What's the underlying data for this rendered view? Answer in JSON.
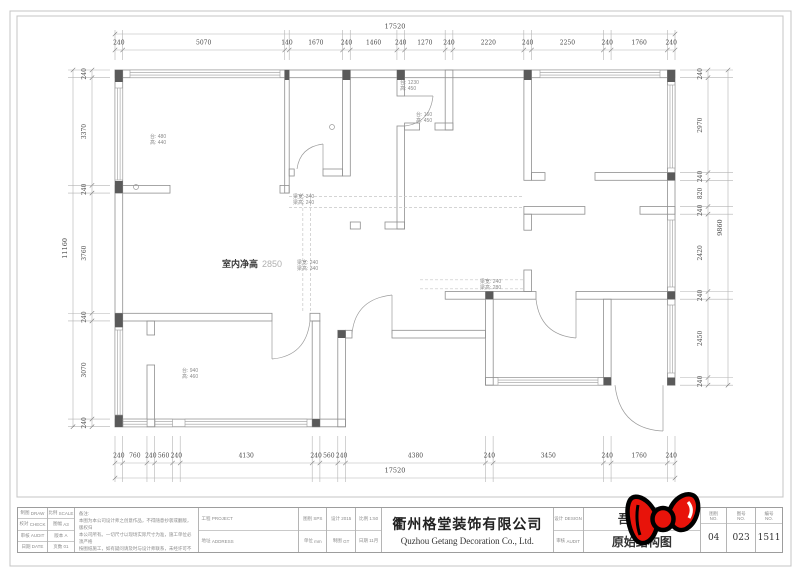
{
  "dimensions": {
    "top": {
      "total": "17520",
      "segments": [
        "240",
        "5070",
        "140",
        "1670",
        "240",
        "1460",
        "240",
        "1270",
        "240",
        "2220",
        "240",
        "2250",
        "240",
        "1760",
        "240"
      ]
    },
    "bottom": {
      "total": "17520",
      "segments": [
        "240",
        "760",
        "240",
        "560",
        "240",
        "4130",
        "240",
        "560",
        "240",
        "4380",
        "240",
        "3450",
        "240",
        "1760",
        "240"
      ]
    },
    "left": {
      "total": "11160",
      "segments": [
        "240",
        "3370",
        "240",
        "3760",
        "240",
        "3070",
        "240"
      ]
    },
    "right": {
      "total": "9860",
      "segments": [
        "240",
        "2970",
        "240",
        "820",
        "240",
        "2420",
        "240",
        "2450",
        "240"
      ]
    }
  },
  "plan": {
    "ceiling_label": "室内净高",
    "ceiling_value": "2850",
    "window_notes": {
      "living": {
        "l1": "台: 480",
        "l2": "高: 440"
      },
      "kitchen": {
        "l1": "台: 1230",
        "l2": "高: 450"
      },
      "bath": {
        "l1": "台: 160",
        "l2": "高: 450"
      },
      "bedroom": {
        "l1": "台: 940",
        "l2": "高: 460"
      }
    },
    "beam_notes": {
      "b1": {
        "l1": "梁宽: 340",
        "l2": "梁高: 240"
      },
      "b2": {
        "l1": "梁宽: 240",
        "l2": "梁高: 340"
      },
      "b3": {
        "l1": "梁宽: 240",
        "l2": "梁高: 280"
      }
    }
  },
  "title_block": {
    "c1": [
      {
        "k": "制图",
        "v": "DRAW"
      },
      {
        "k": "校对",
        "v": "CHECK"
      },
      {
        "k": "审核",
        "v": "AUDIT"
      },
      {
        "k": "日期",
        "v": "DATE"
      }
    ],
    "c2": [
      {
        "k": "比例",
        "v": "SCALE"
      },
      {
        "k": "图幅",
        "v": "A3"
      },
      {
        "k": "版本",
        "v": "A"
      },
      {
        "k": "页数",
        "v": "01"
      }
    ],
    "notes_title": "备注:",
    "notes": [
      "本图为本公司设计师之创意作品，不得随意抄袭或翻版，版权归",
      "本公司所有。一切尺寸以现场实际尺寸为准，施工单位必须严格",
      "按图纸施工，如有疑问请及时与设计师联系，未经许可不得擅自",
      "修改，凡私自改动本图所造成的后果本公司概不负责。"
    ],
    "c4": [
      {
        "k": "工程",
        "v": "PROJECT"
      },
      {
        "k": "地址",
        "v": "ADDRESS"
      }
    ],
    "c5": [
      {
        "k": "图别",
        "v": "SPS"
      },
      {
        "k": "单位",
        "v": "mm"
      }
    ],
    "c6": [
      {
        "k": "设计",
        "v": "2015"
      },
      {
        "k": "制图",
        "v": "GT"
      }
    ],
    "c7": [
      {
        "k": "比例",
        "v": "1:50"
      },
      {
        "k": "日期",
        "v": "11月"
      }
    ],
    "company_cn": "衢州格堂装饰有限公司",
    "company_en": "Quzhou Getang Decoration Co., Ltd.",
    "c9": [
      {
        "k": "设计",
        "v": "DESIGN"
      },
      {
        "k": "审核",
        "v": "AUDIT"
      }
    ],
    "project_name": "吾悦广场",
    "drawing_name": "原始结构图",
    "num_cols": [
      {
        "h": "图别",
        "s": "NO.",
        "v": "04"
      },
      {
        "h": "图号",
        "s": "NO.",
        "v": "023"
      },
      {
        "h": "编号",
        "s": "NO.",
        "v": "1511"
      }
    ]
  },
  "sticker": {
    "name": "red-bow-sticker",
    "fill": "#e8130a",
    "outline": "#000000"
  }
}
